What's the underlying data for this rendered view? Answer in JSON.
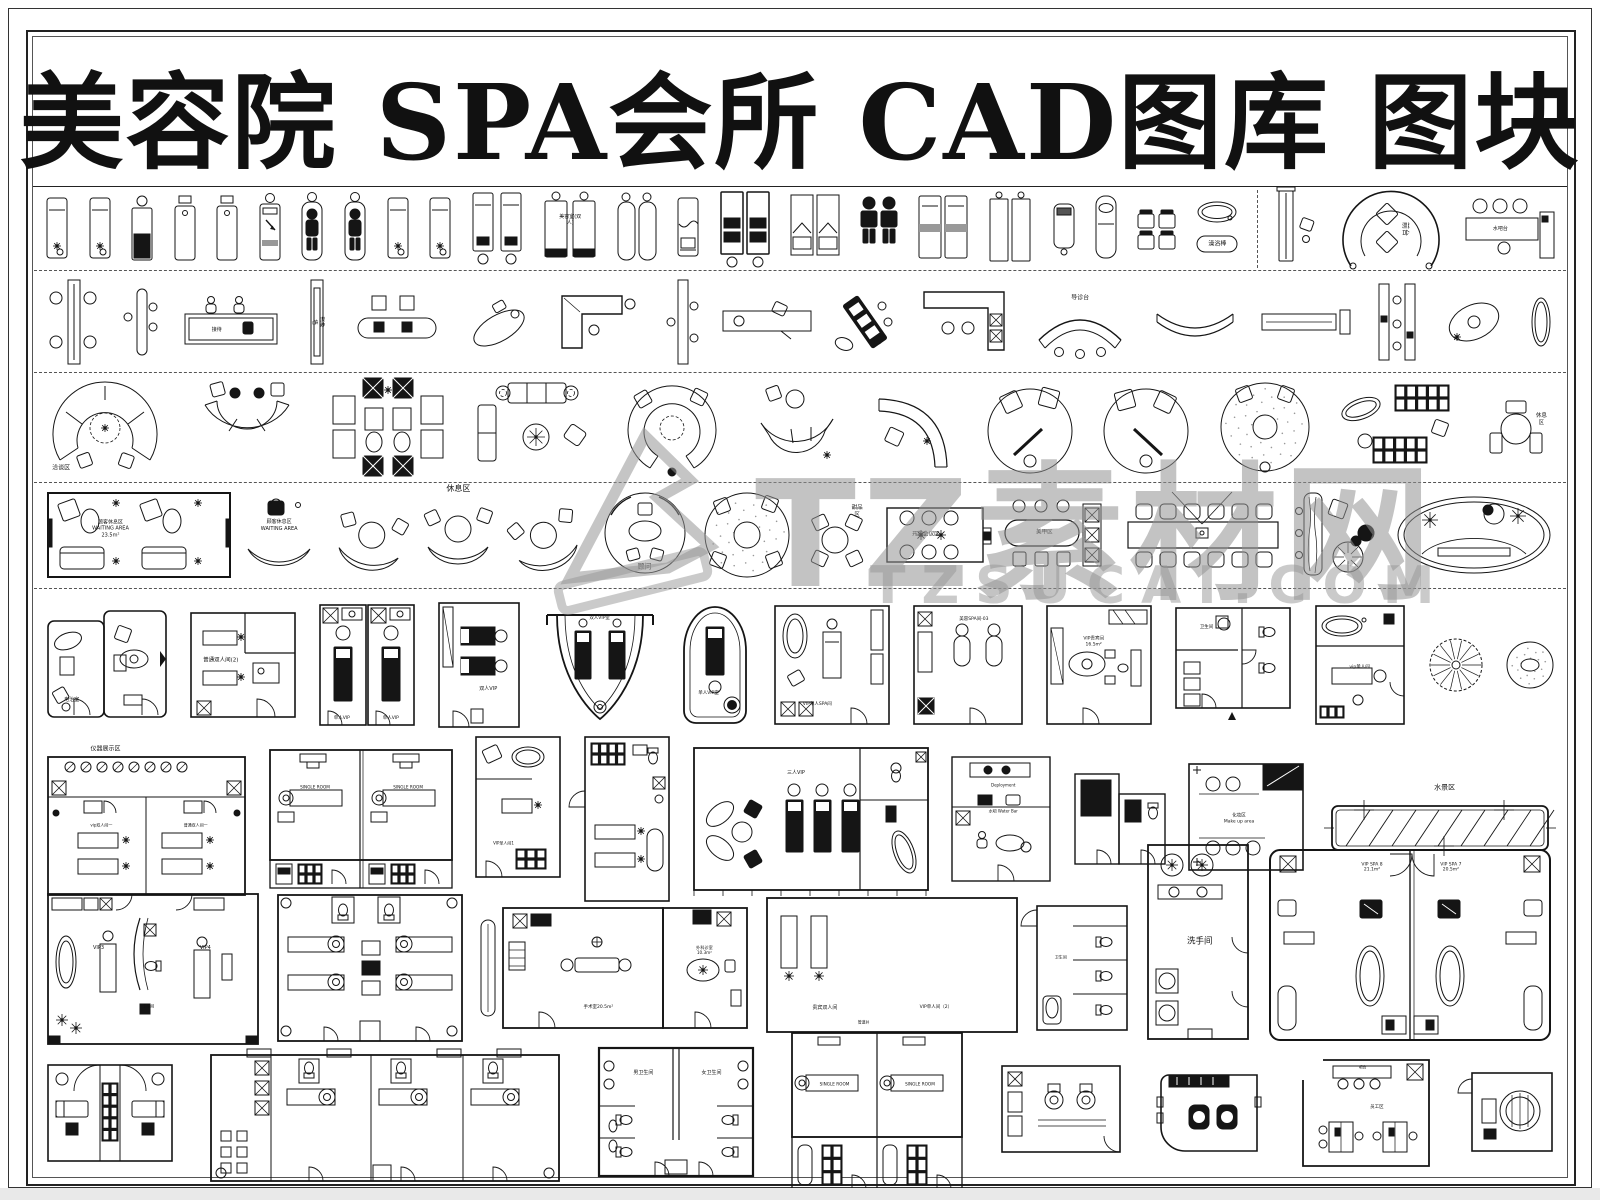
{
  "page": {
    "title": "美容院 SPA会所 CAD图库 图块"
  },
  "watermark": {
    "brand": "TZ素材网",
    "domain": "TZSUCAI.COM"
  },
  "colors": {
    "line": "#151515",
    "watermark": "#9a9a9a",
    "accent_dark": "#111111"
  },
  "rows": [
    {
      "name": "massage-beds",
      "items": [
        {
          "t": "bedF"
        },
        {
          "t": "bedF"
        },
        {
          "t": "bedDark"
        },
        {
          "t": "bedSq"
        },
        {
          "t": "bedSq"
        },
        {
          "t": "bedArrow"
        },
        {
          "t": "bedPerson"
        },
        {
          "t": "bedPerson"
        },
        {
          "t": "bedF"
        },
        {
          "t": "bedF"
        },
        {
          "t": "bedPairStool"
        },
        {
          "t": "bedPairLabel",
          "label": "美容室(双人)"
        },
        {
          "t": "bedPairRound"
        },
        {
          "t": "bedBlanket"
        },
        {
          "t": "bedPairDark"
        },
        {
          "t": "bedPairFold"
        },
        {
          "t": "figures"
        },
        {
          "t": "bedPairBand"
        },
        {
          "t": "bedPairTall"
        },
        {
          "t": "bedSmallDark"
        },
        {
          "t": "bedBody"
        },
        {
          "t": "chairGrid"
        },
        {
          "t": "tubSet",
          "label": "澡浴棒"
        },
        {
          "t": "vdash"
        },
        {
          "t": "shelfStool"
        },
        {
          "t": "curveDesk",
          "label": "前台"
        },
        {
          "t": "barCounter",
          "label": "水吧台"
        }
      ]
    },
    {
      "name": "reception-counters",
      "items": [
        {
          "t": "panel4c"
        },
        {
          "t": "panel2c"
        },
        {
          "t": "deskPersons",
          "label": "接待"
        },
        {
          "t": "panelV",
          "label": "形象墙"
        },
        {
          "t": "deskStools"
        },
        {
          "t": "tiltDesk"
        },
        {
          "t": "deskL"
        },
        {
          "t": "panel3c"
        },
        {
          "t": "deskChair"
        },
        {
          "t": "tiltDark"
        },
        {
          "t": "deskL2"
        },
        {
          "t": "curveDesk2",
          "label": "导诊台"
        },
        {
          "t": "arcBench"
        },
        {
          "t": "deskSign"
        },
        {
          "t": "panelsPair"
        },
        {
          "t": "ovalPerson"
        },
        {
          "t": "mirror"
        }
      ]
    },
    {
      "name": "sofa-groups",
      "items": [
        {
          "t": "arcCluster",
          "label": "洽谈区"
        },
        {
          "t": "arcU"
        },
        {
          "t": "squareSet"
        },
        {
          "t": "sofaSet"
        },
        {
          "t": "ringSofa"
        },
        {
          "t": "segArc"
        },
        {
          "t": "arcChaise"
        },
        {
          "t": "rugRound"
        },
        {
          "t": "rugRound2"
        },
        {
          "t": "dotRug"
        },
        {
          "t": "lockerSet"
        },
        {
          "t": "triTable",
          "label": "休息区"
        }
      ]
    },
    {
      "name": "waiting-areas",
      "items": [
        {
          "t": "waitingRoom",
          "label": "顾客休息区\nWAITING AREA\n23.5m²"
        },
        {
          "t": "crescentBench",
          "label": "顾客休息区\nWAITING AREA"
        },
        {
          "t": "crescents",
          "label": "休息区"
        },
        {
          "t": "consultTable",
          "label": "顾问"
        },
        {
          "t": "dotRugChairs"
        },
        {
          "t": "dessert",
          "label": "甜品区"
        },
        {
          "t": "confSmall",
          "label": "开放会议区"
        },
        {
          "t": "nailBar",
          "label": "美甲区"
        },
        {
          "t": "confLong"
        },
        {
          "t": "logBench"
        },
        {
          "t": "ovalBig"
        }
      ]
    },
    {
      "name": "vip-rooms-1",
      "items": [
        {
          "t": "combo",
          "label": "电治室"
        },
        {
          "t": "sq2",
          "label": "普通双人间(2)"
        },
        {
          "t": "twin",
          "labels": [
            "单人VIP",
            "单人VIP"
          ]
        },
        {
          "t": "dbl",
          "label": "双人VIP"
        },
        {
          "t": "archU",
          "label": "双人VIP室"
        },
        {
          "t": "ovalRoom",
          "label": "单人VIP室"
        },
        {
          "t": "spaRoom",
          "label": "VIP单人SPA间"
        },
        {
          "t": "beauty",
          "label": "美容SPA间-03"
        },
        {
          "t": "viplounge",
          "label": "VIP贵宾间\n16.5m²"
        },
        {
          "t": "wcplan",
          "label": "卫生间"
        },
        {
          "t": "vipsingle",
          "label": "vip单人间"
        },
        {
          "t": "tree"
        },
        {
          "t": "dotrugS"
        }
      ]
    },
    {
      "name": "vip-rooms-2",
      "items": [
        {
          "t": "big2",
          "labels": [
            "仪器展示区",
            "vip双人间一",
            "普通双人间一"
          ]
        },
        {
          "t": "single2",
          "labels": [
            "SINGLE ROOM",
            "SINGLE ROOM"
          ]
        },
        {
          "t": "vip1",
          "label": "VIP单人间1"
        },
        {
          "t": "tall2"
        },
        {
          "t": "threevip",
          "label": "三人VIP"
        },
        {
          "t": "dev",
          "labels": [
            "Deployment",
            "水吧 Water Bar"
          ]
        },
        {
          "t": "darkpair"
        },
        {
          "t": "makeup",
          "label": "化妆区\nMake up area"
        },
        {
          "t": "pool",
          "label": "水景区"
        }
      ]
    },
    {
      "name": "vip-rooms-3",
      "items": [
        {
          "t": "vip34",
          "labels": [
            "VIP3",
            "VIP4",
            "卫生间"
          ]
        },
        {
          "t": "fourbed"
        },
        {
          "t": "surg",
          "labels": [
            "手术室20.5m²",
            "外科诊室\n10.3m²"
          ]
        },
        {
          "t": "guest",
          "labels": [
            "贵宾双人间",
            "VIP单人间（2）",
            "管道井"
          ]
        },
        {
          "t": "wc3",
          "label": "卫生间"
        },
        {
          "t": "washroom",
          "label": "洗手间"
        },
        {
          "t": "vipspa",
          "labels": [
            "VIP SPA 8\n21.1m²",
            "VIP SPA 7\n20.5m²"
          ]
        }
      ]
    },
    {
      "name": "bottom-rooms",
      "items": [
        {
          "t": "couple"
        },
        {
          "t": "longblock"
        },
        {
          "t": "mf",
          "labels": [
            "男卫生间",
            "女卫生间"
          ]
        },
        {
          "t": "singles2",
          "labels": [
            "SINGLE ROOM",
            "SINGLE ROOM"
          ]
        },
        {
          "t": "wc2"
        },
        {
          "t": "deskdark"
        },
        {
          "t": "staff",
          "labels": [
            "员工区",
            "吧台"
          ]
        },
        {
          "t": "smallsq"
        }
      ]
    }
  ]
}
